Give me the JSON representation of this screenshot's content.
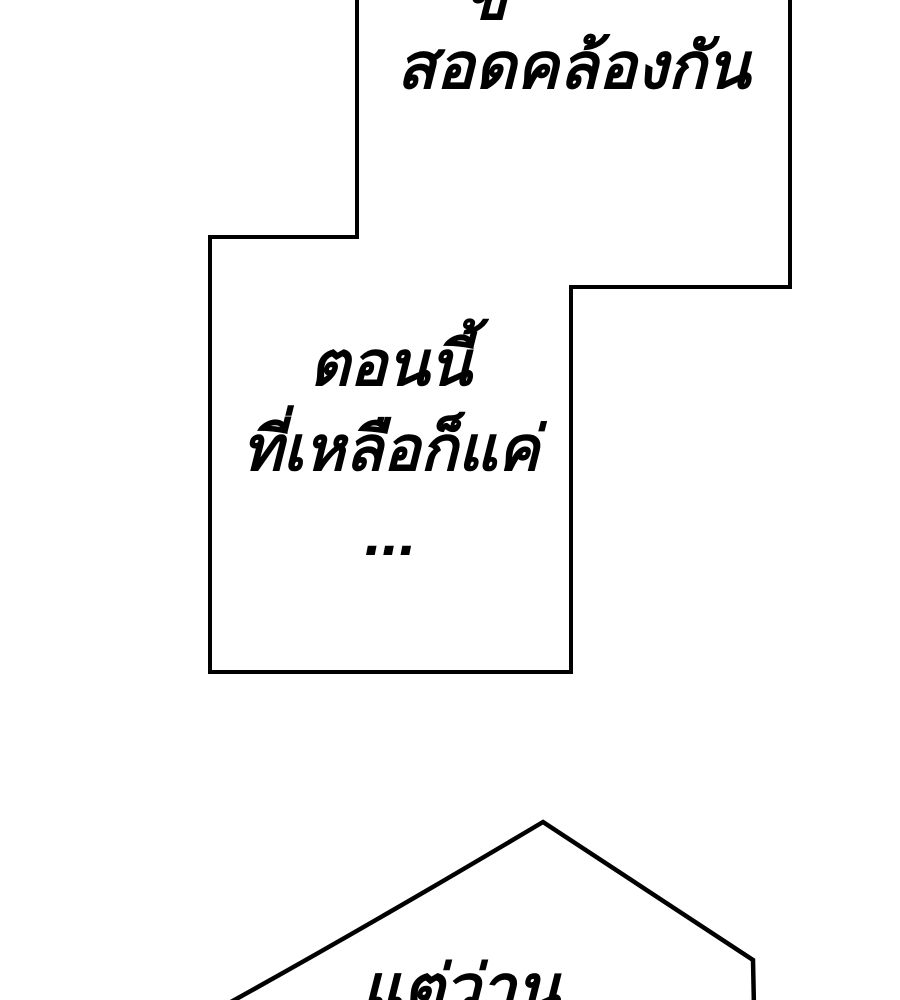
{
  "page": {
    "type": "comic-panel",
    "background_color": "#ffffff",
    "ink_color": "#000000"
  },
  "bubbles": {
    "top": {
      "clipped_fragment": "ข",
      "text": "สอดคล้องกัน"
    },
    "middle": {
      "lines": [
        "ตอนนี้",
        "ที่เหลือก็แค่",
        "..."
      ]
    },
    "bottom": {
      "text": "แต่ว่าน..."
    }
  }
}
